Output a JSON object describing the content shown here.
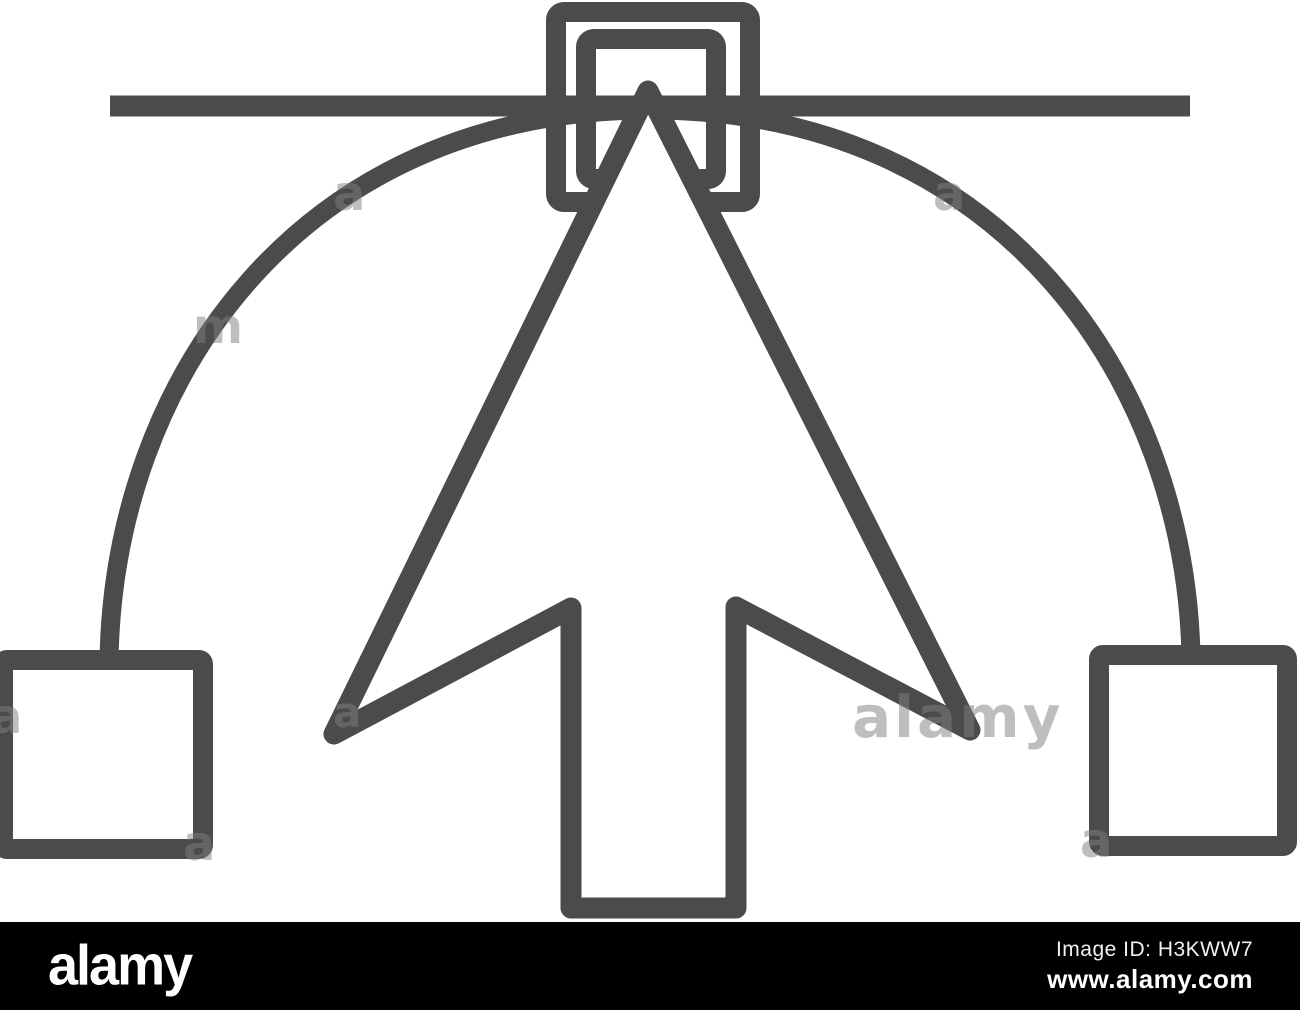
{
  "colors": {
    "background": "#ffffff",
    "icon_stroke": "#4a4b4d",
    "arrow_fill": "#ffffff",
    "watermark": "#7f7f7f",
    "footer_bg": "#000000",
    "footer_text": "#ffffff"
  },
  "icon": {
    "parts": [
      "bezier-path-line",
      "bezier-curve",
      "left-control-handle-node",
      "right-control-handle-node",
      "anchor-point-outer-square",
      "anchor-point-inner-square",
      "cursor-arrow"
    ]
  },
  "watermarks": {
    "center": "alamy",
    "letters": [
      "a",
      "a",
      "a",
      "m",
      "a",
      "a",
      "a"
    ]
  },
  "footer": {
    "logo": "alamy",
    "image_id": "Image ID: H3KWW7",
    "url": "www.alamy.com"
  }
}
